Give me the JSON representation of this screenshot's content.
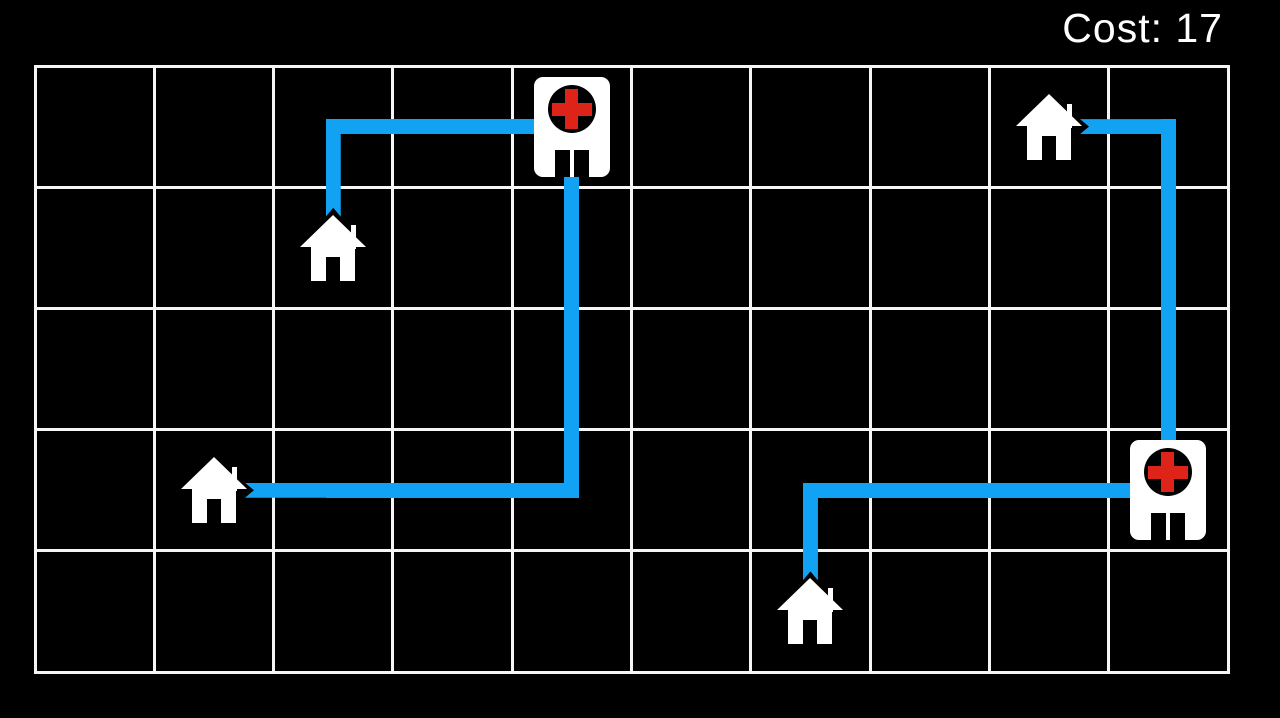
{
  "hud": {
    "cost_text": "Cost: 17",
    "cost_label": "Cost:",
    "cost_value": 17
  },
  "colors": {
    "background": "#000000",
    "grid_line": "#f5f5f5",
    "path_blue": "#12a2f3",
    "cross_red": "#de2418",
    "building_white": "#ffffff"
  },
  "grid": {
    "columns": 10,
    "rows": 5,
    "x": 35,
    "y": 66,
    "width": 1193,
    "height": 606,
    "line_thickness": 3
  },
  "buildings": [
    {
      "id": "hospital-1",
      "type": "hospital",
      "col": 4,
      "row": 0
    },
    {
      "id": "hospital-2",
      "type": "hospital",
      "col": 9,
      "row": 3
    },
    {
      "id": "house-1",
      "type": "house",
      "col": 2,
      "row": 1
    },
    {
      "id": "house-2",
      "type": "house",
      "col": 1,
      "row": 3
    },
    {
      "id": "house-3",
      "type": "house",
      "col": 8,
      "row": 0
    },
    {
      "id": "house-4",
      "type": "house",
      "col": 6,
      "row": 4
    }
  ],
  "routes": [
    {
      "id": "route-1",
      "from": "hospital-1",
      "to": "house-1",
      "cost": 3,
      "cells": [
        [
          4,
          0
        ],
        [
          3,
          0
        ],
        [
          2,
          0
        ],
        [
          2,
          1
        ]
      ]
    },
    {
      "id": "route-2",
      "from": "hospital-1",
      "to": "house-2",
      "cost": 6,
      "cells": [
        [
          4,
          0
        ],
        [
          4,
          1
        ],
        [
          4,
          2
        ],
        [
          4,
          3
        ],
        [
          3,
          3
        ],
        [
          2,
          3
        ],
        [
          1,
          3
        ]
      ]
    },
    {
      "id": "route-3",
      "from": "hospital-2",
      "to": "house-3",
      "cost": 4,
      "cells": [
        [
          9,
          3
        ],
        [
          9,
          2
        ],
        [
          9,
          1
        ],
        [
          9,
          0
        ],
        [
          8,
          0
        ]
      ]
    },
    {
      "id": "route-4",
      "from": "hospital-2",
      "to": "house-4",
      "cost": 4,
      "cells": [
        [
          9,
          3
        ],
        [
          8,
          3
        ],
        [
          7,
          3
        ],
        [
          6,
          3
        ],
        [
          6,
          4
        ]
      ]
    }
  ]
}
